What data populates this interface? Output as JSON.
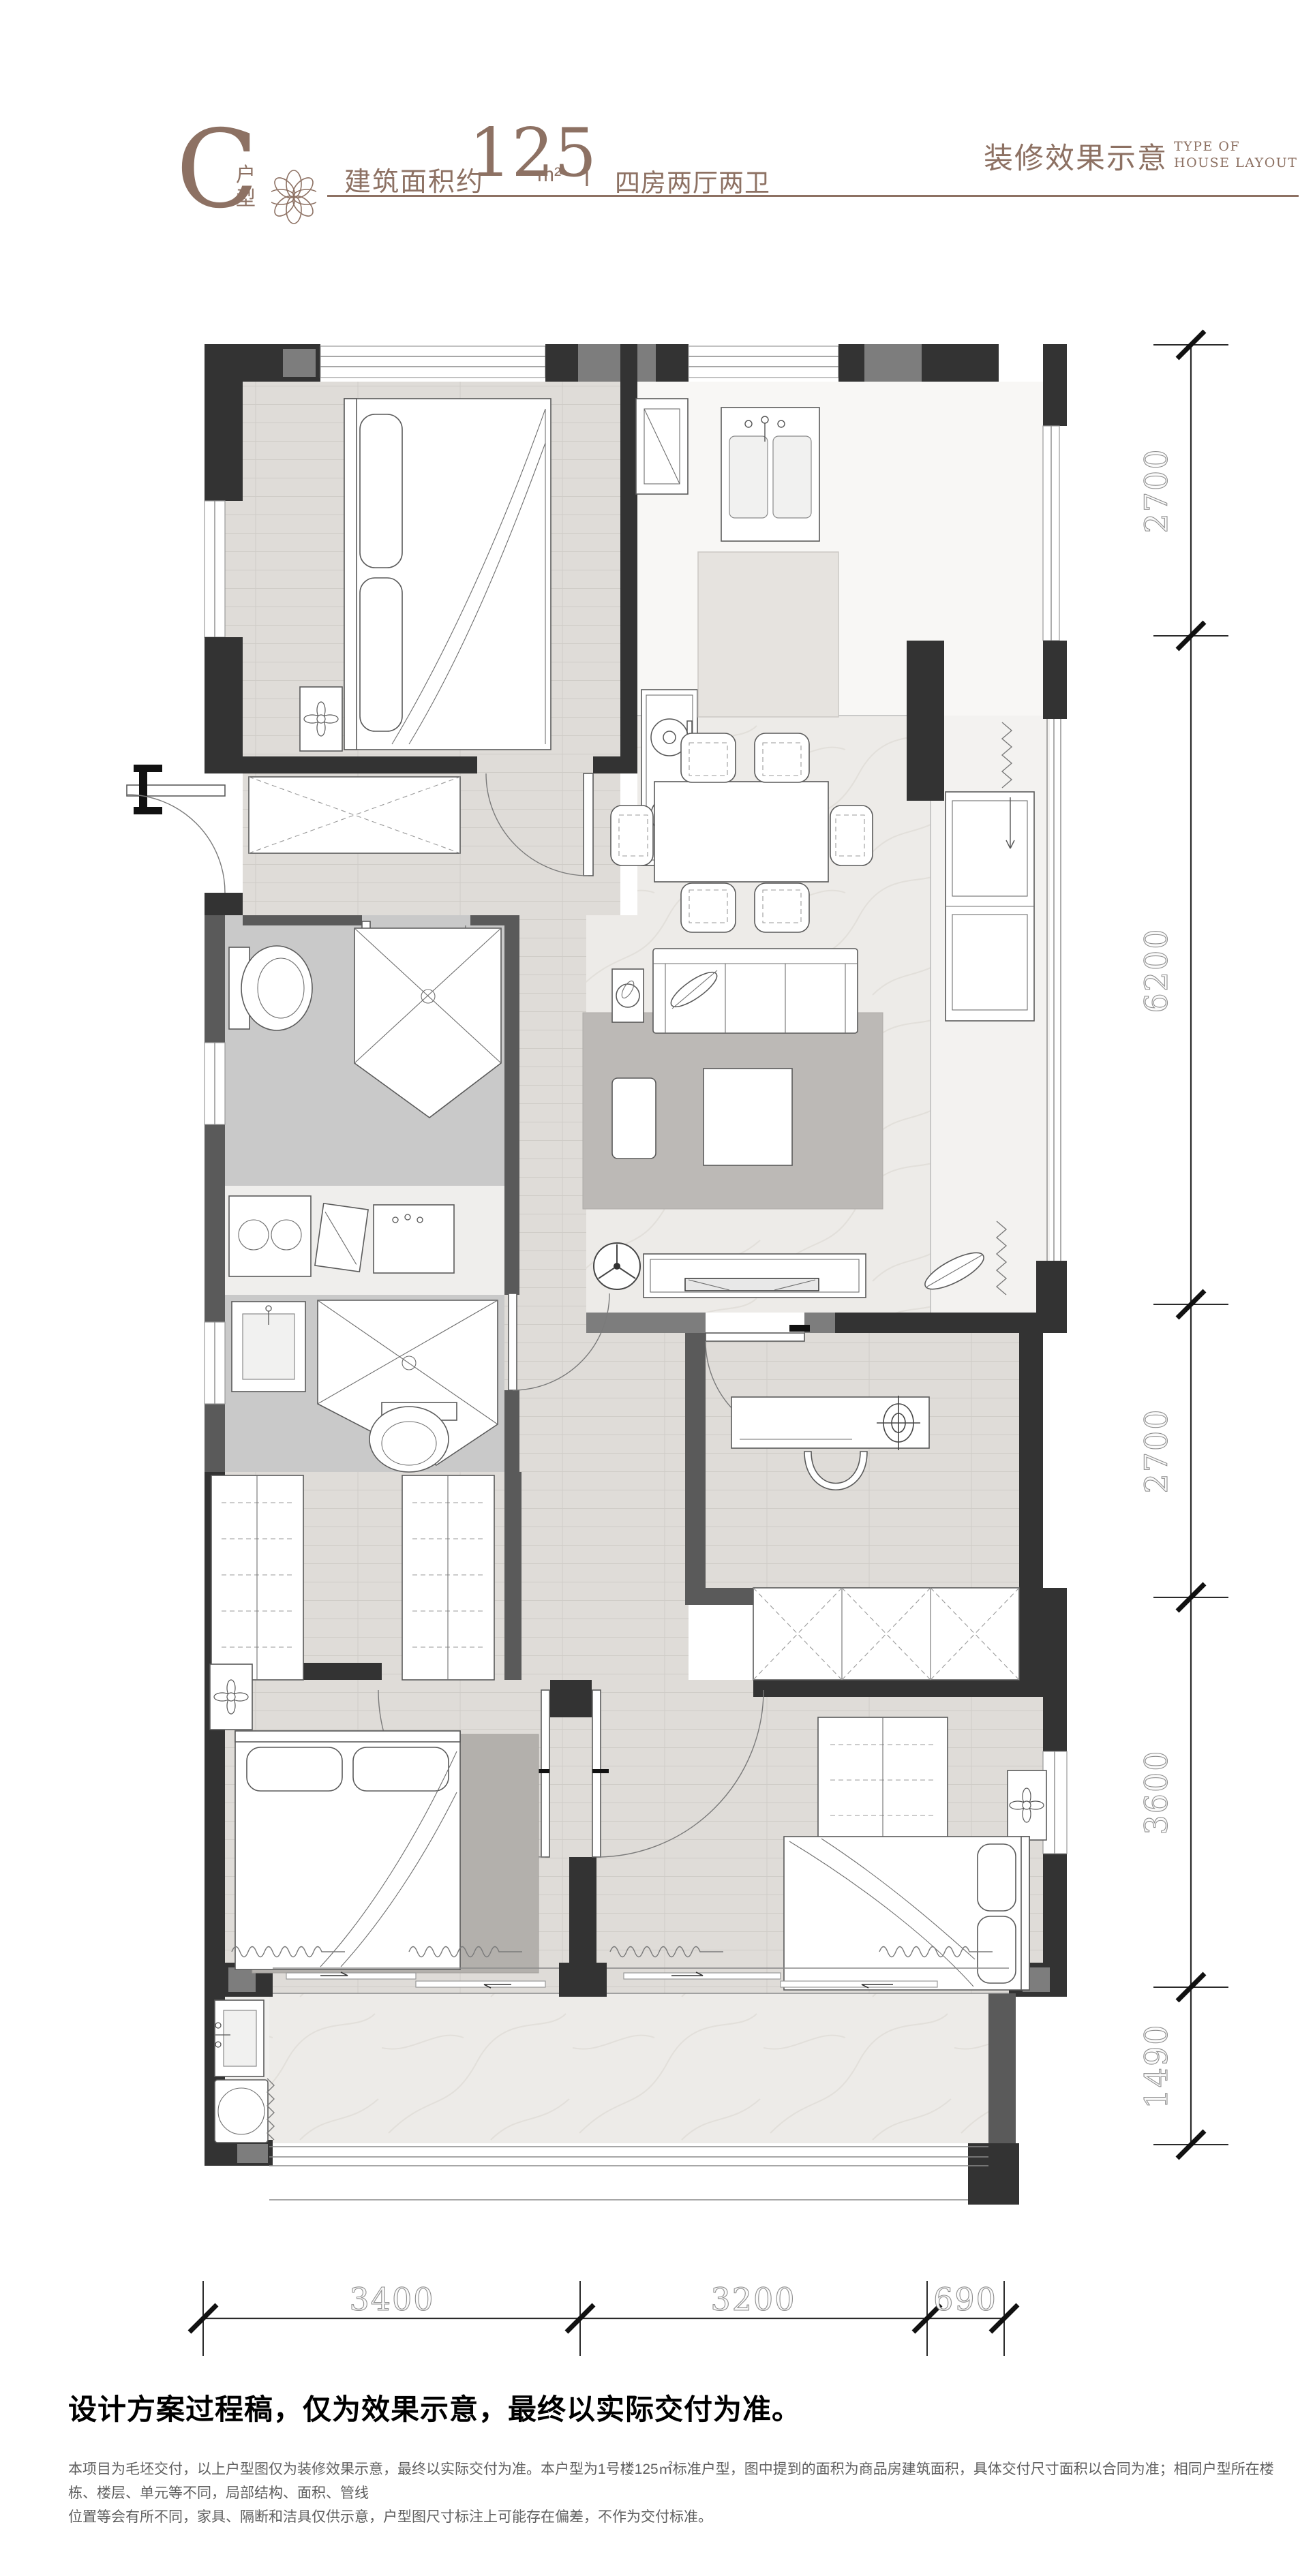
{
  "header": {
    "unit_letter": "C",
    "unit_label": "户型",
    "area_prefix": "建筑面积约",
    "area_value": "125",
    "area_unit": "m²",
    "separator": "|",
    "rooms_text": "四房两厅两卫",
    "title_right": "装修效果示意",
    "title_right_en_line1": "TYPE OF",
    "title_right_en_line2": "HOUSE LAYOUT"
  },
  "plan": {
    "dims_right": [
      {
        "label": "2700"
      },
      {
        "label": "6200"
      },
      {
        "label": "2700"
      },
      {
        "label": "3600"
      },
      {
        "label": "1490"
      }
    ],
    "dims_bottom": [
      {
        "label": "3400"
      },
      {
        "label": "3200"
      },
      {
        "label": "690"
      }
    ]
  },
  "footer": {
    "statement": "设计方案过程稿，仅为效果示意，最终以实际交付为准。",
    "disclaimer_line1": "本项目为毛坯交付，以上户型图仅为装修效果示意，最终以实际交付为准。本户型为1号楼125㎡标准户型，图中提到的面积为商品房建筑面积，具体交付尺寸面积以合同为准；相同户型所在楼栋、楼层、单元等不同，局部结构、面积、管线",
    "disclaimer_line2": "位置等会有所不同，家具、隔断和洁具仅供示意，户型图尺寸标注上可能存在偏差，不作为交付标准。"
  },
  "colors": {
    "accent_brown": "#8d7163",
    "wall_dark": "#333333"
  }
}
